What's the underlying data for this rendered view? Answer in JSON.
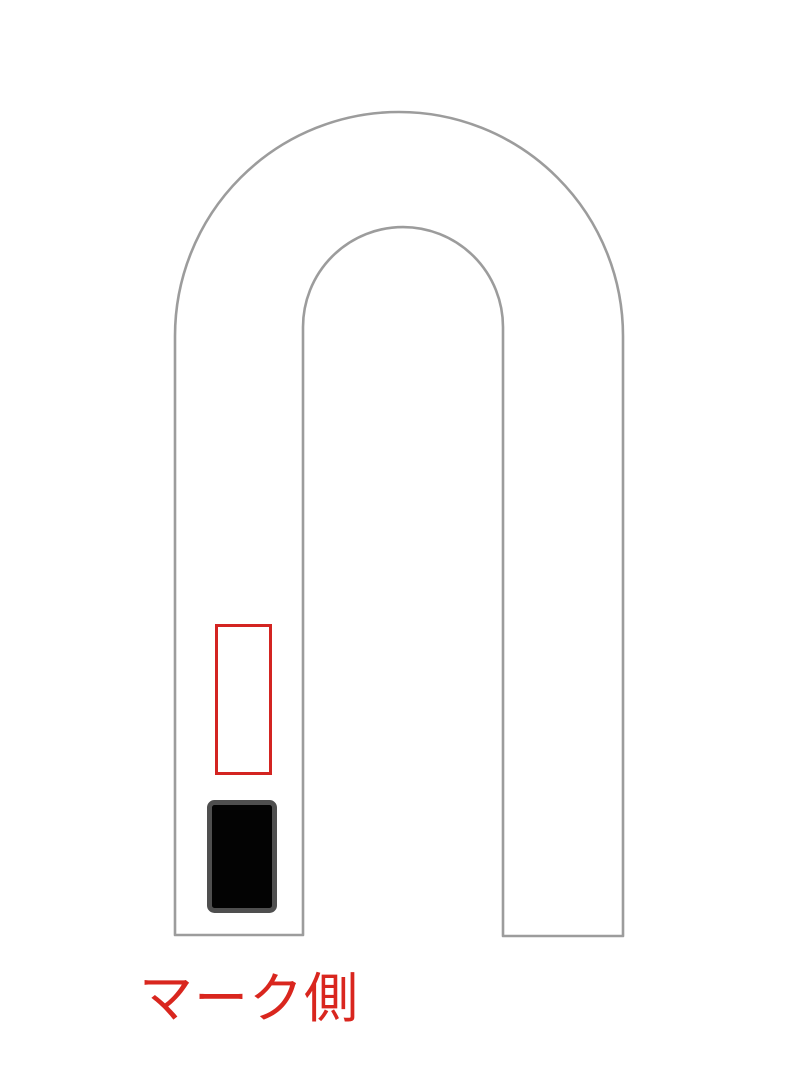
{
  "diagram": {
    "background_color": "#ffffff",
    "outline": {
      "description": "inverted-U shaped part outline",
      "stroke_color": "#9c9c9c"
    },
    "empty_slot": {
      "description": "empty mark position outline on left leg",
      "stroke_color": "#d32421"
    },
    "filled_slot": {
      "description": "black mark block on left leg",
      "fill_color": "#030303",
      "border_color": "#4f4f4f"
    },
    "caption": {
      "text": "マーク側",
      "color": "#d9261e"
    }
  }
}
